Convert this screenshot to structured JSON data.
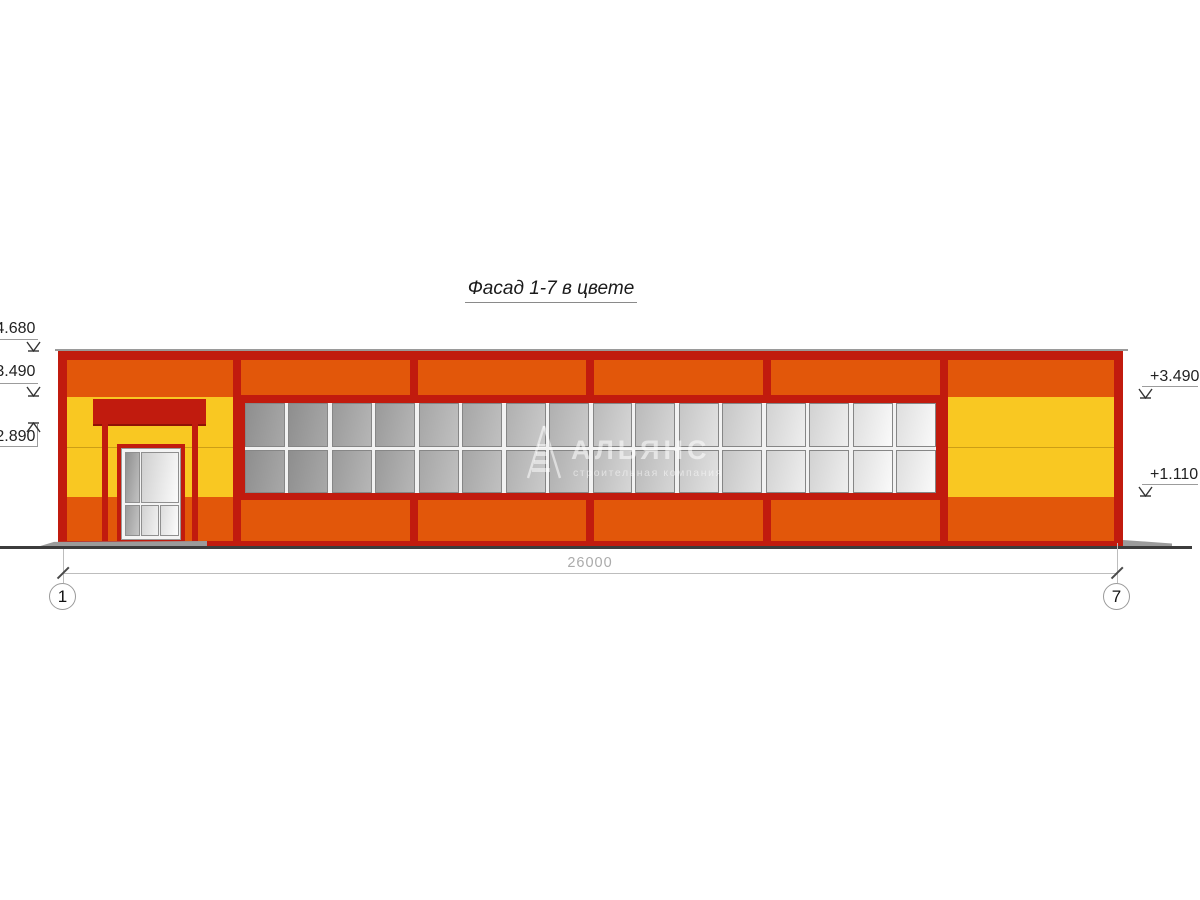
{
  "title": {
    "text": "Фасад 1-7 в цвете"
  },
  "levels": {
    "left": [
      {
        "value": "+4.680"
      },
      {
        "value": "+3.490"
      },
      {
        "value": "+2.890"
      }
    ],
    "right": [
      {
        "value": "+3.490"
      },
      {
        "value": "+1.110"
      }
    ]
  },
  "dimension": {
    "value": "26000"
  },
  "axes": {
    "left": "1",
    "right": "7"
  },
  "watermark": {
    "name": "АЛЬЯНС",
    "subtitle": "строительная компания",
    "logo": "pyramid-logo"
  },
  "colors": {
    "orange": "#E2570A",
    "yellow": "#F9C822",
    "darkred": "#C11B0E",
    "ground": "#3C3C3C",
    "dimline": "#BDBDBD",
    "dimtext": "#ABABAB",
    "glass_dark": "#8E8E8E",
    "glass_light": "#F4F4F4"
  },
  "windows": {
    "units": 8,
    "cols_per_unit": 2,
    "rows": 2,
    "unit_shades": [
      [
        "#8E8E8E",
        "#A8A8A8"
      ],
      [
        "#9A9A9A",
        "#B6B6B6"
      ],
      [
        "#A6A6A6",
        "#C0C0C0"
      ],
      [
        "#B0B0B0",
        "#CACACA"
      ],
      [
        "#BABABA",
        "#D6D6D6"
      ],
      [
        "#C6C6C6",
        "#E2E2E2"
      ],
      [
        "#D2D2D2",
        "#EEEEEE"
      ],
      [
        "#DEDEDE",
        "#FAFAFA"
      ]
    ]
  }
}
